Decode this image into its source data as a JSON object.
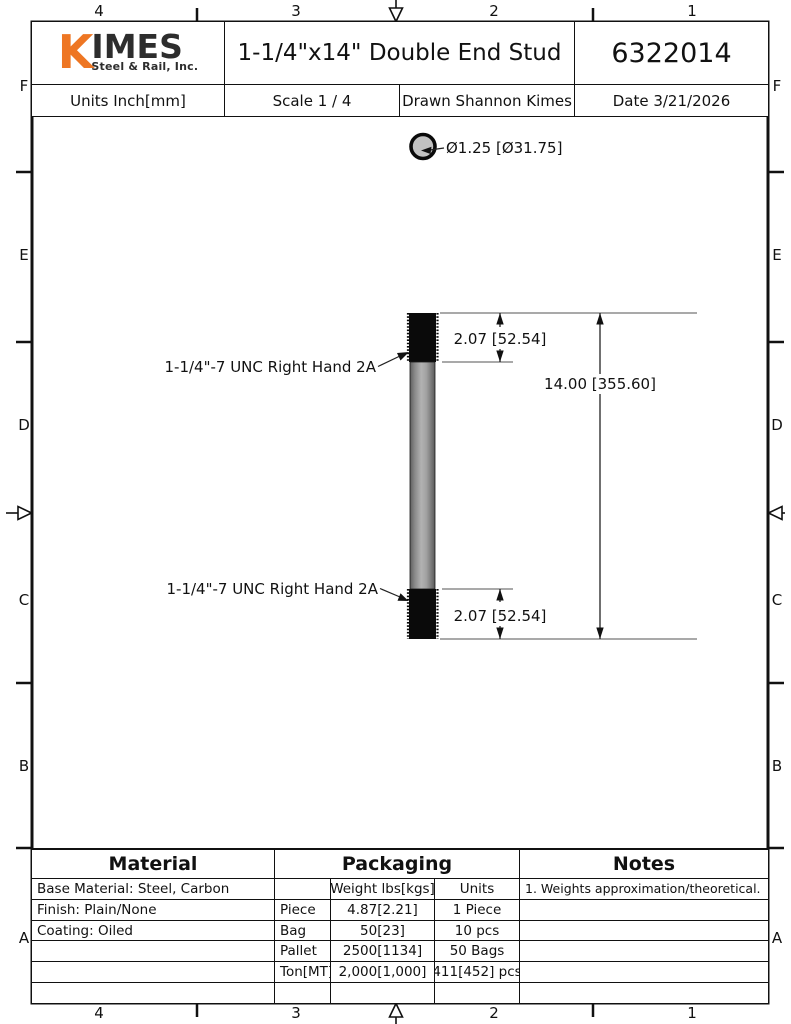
{
  "colors": {
    "accent": "#EE7623",
    "ink": "#111111",
    "steel_light": "#b2b2b2",
    "steel_dark": "#636363"
  },
  "border_zones": {
    "top_labels": [
      "4",
      "3",
      "2",
      "1"
    ],
    "bottom_labels": [
      "4",
      "3",
      "2",
      "1"
    ],
    "left_labels": [
      "F",
      "E",
      "D",
      "C",
      "B",
      "A"
    ],
    "right_labels": [
      "F",
      "E",
      "D",
      "C",
      "B",
      "A"
    ]
  },
  "title_block": {
    "logo": {
      "k": "K",
      "imes": "IMES",
      "subtitle": "Steel & Rail, Inc."
    },
    "title": "1-1/4\"x14\" Double End Stud",
    "part_number": "6322014",
    "units": "Units Inch[mm]",
    "scale": "Scale 1 / 4",
    "drawn": "Drawn Shannon Kimes",
    "date": "Date 3/21/2026"
  },
  "drawing": {
    "diameter_callout": "Ø1.25 [Ø31.75]",
    "top_thread_label": "1-1/4\"-7 UNC Right Hand 2A",
    "bottom_thread_label": "1-1/4\"-7 UNC Right Hand 2A",
    "top_thread_dim": "2.07 [52.54]",
    "bottom_thread_dim": "2.07 [52.54]",
    "overall_length_dim": "14.00 [355.60]"
  },
  "tables": {
    "material": {
      "header": "Material",
      "rows": [
        "Base Material: Steel, Carbon",
        "Finish: Plain/None",
        "Coating: Oiled"
      ]
    },
    "packaging": {
      "header": "Packaging",
      "col_headers": [
        "",
        "Weight lbs[kgs]",
        "Units"
      ],
      "rows": [
        [
          "Piece",
          "4.87[2.21]",
          "1 Piece"
        ],
        [
          "Bag",
          "50[23]",
          "10 pcs"
        ],
        [
          "Pallet",
          "2500[1134]",
          "50 Bags"
        ],
        [
          "Ton[MT]",
          "2,000[1,000]",
          "411[452] pcs"
        ]
      ]
    },
    "notes": {
      "header": "Notes",
      "items": [
        "1. Weights approximation/theoretical."
      ]
    }
  }
}
